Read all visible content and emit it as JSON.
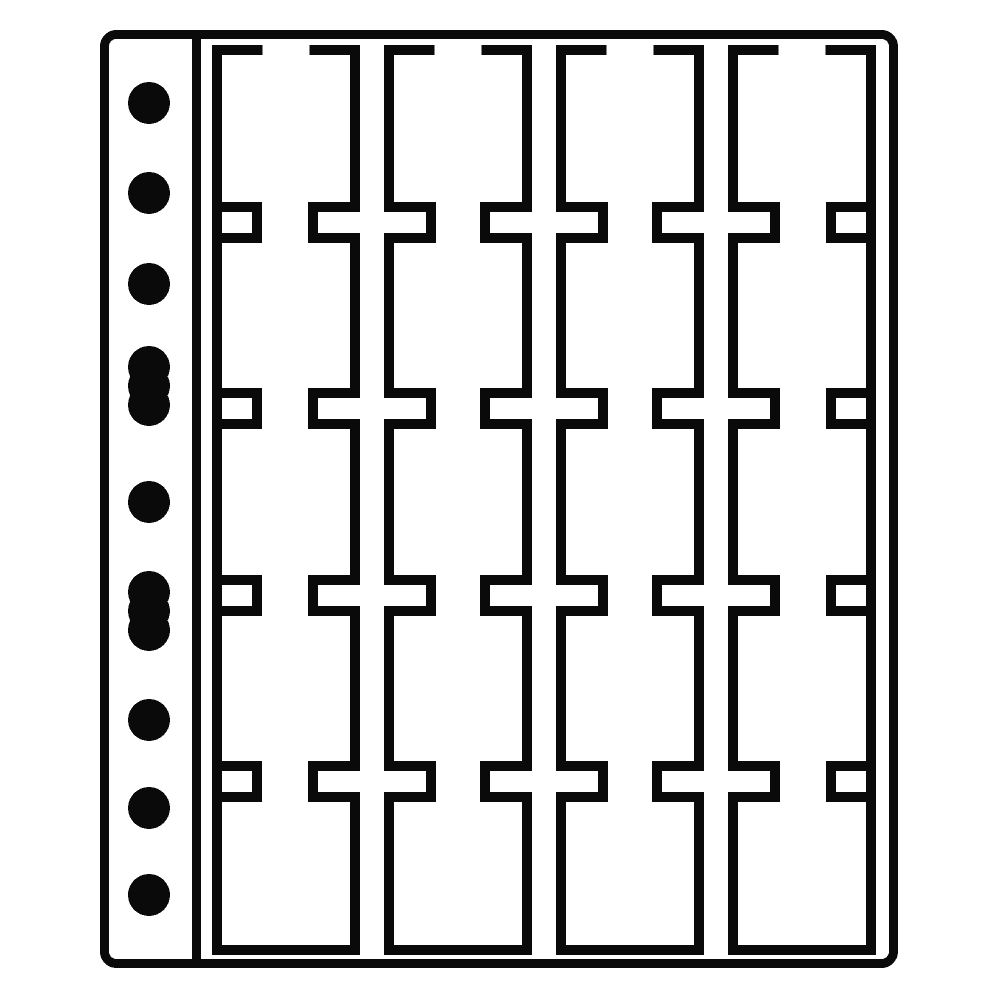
{
  "image": {
    "type": "product-line-art",
    "subject": "Coin album pocket sheet with 20 vertical pockets, T-slot openings and a multi-punched binder margin",
    "background_color": "#ffffff",
    "line_color": "#0a0a0a"
  },
  "sheet": {
    "pocket_columns": 4,
    "pocket_rows": 5,
    "pocket_count": 20,
    "binding_holes": [
      {
        "type": "round"
      },
      {
        "type": "round"
      },
      {
        "type": "round"
      },
      {
        "type": "oblong"
      },
      {
        "type": "round"
      },
      {
        "type": "oblong"
      },
      {
        "type": "round"
      },
      {
        "type": "round"
      },
      {
        "type": "round"
      }
    ]
  }
}
